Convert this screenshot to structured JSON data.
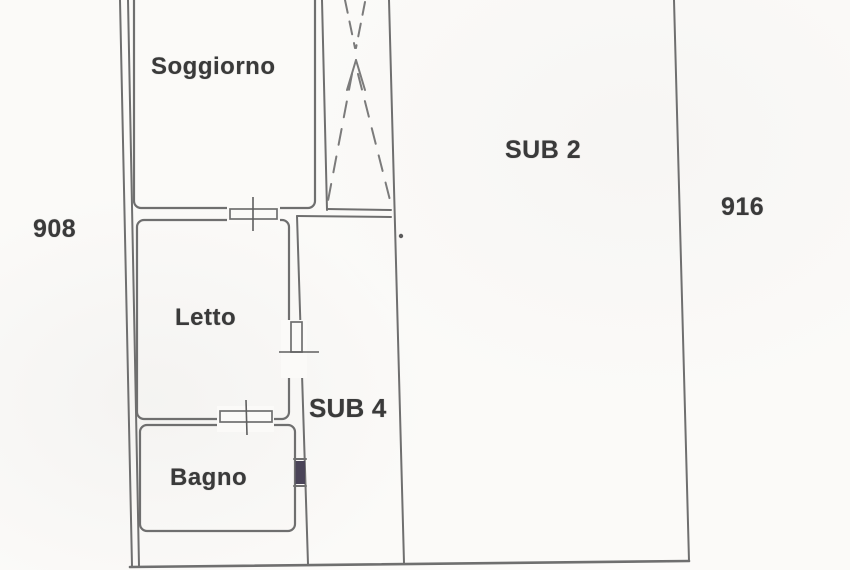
{
  "plan": {
    "rooms": [
      {
        "id": "soggiorno",
        "label": "Soggiorno"
      },
      {
        "id": "letto",
        "label": "Letto"
      },
      {
        "id": "bagno",
        "label": "Bagno"
      }
    ],
    "units": [
      {
        "id": "sub2",
        "label": "SUB 2"
      },
      {
        "id": "sub4",
        "label": "SUB 4"
      }
    ],
    "parcels": [
      {
        "id": "parcel-left",
        "value": "908"
      },
      {
        "id": "parcel-right",
        "value": "916"
      }
    ],
    "symbols": [
      {
        "id": "stairwell",
        "name": "dashed-stair-shaft"
      },
      {
        "id": "door-soggiorno-letto",
        "name": "door-with-tick"
      },
      {
        "id": "door-letto-bagno",
        "name": "door-with-tick"
      },
      {
        "id": "door-letto-sub4",
        "name": "door-with-tick"
      },
      {
        "id": "window-bagno",
        "name": "filled-window"
      }
    ],
    "colors": {
      "paper": "#fbfaf8",
      "wall": "#6f6f6f",
      "text": "#3a3a3a",
      "window": "#4a4458"
    }
  }
}
